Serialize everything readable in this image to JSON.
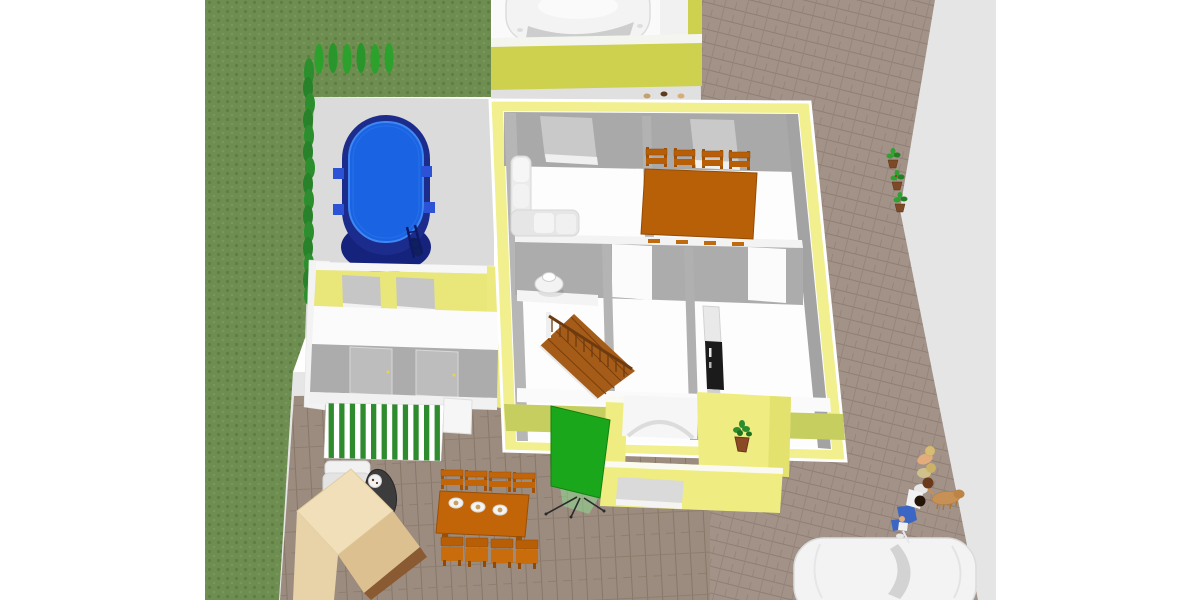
{
  "view": {
    "type": "3d-home-design-render",
    "camera": "aerial-oblique",
    "background": "#ffffff"
  },
  "colors": {
    "grass": "#6D8E50",
    "grass_dot_dark": "#5E7E42",
    "grass_dot_light": "#7B9B5C",
    "hedge_green": "#2C8F2E",
    "tree_green": "#2CA12C",
    "deck": "#DBDBDB",
    "ground_gray": "#E5E5E5",
    "pool_rim": "#1B2C8C",
    "pool_water": "#1A64E4",
    "house_wall": "#F1EF8E",
    "house_wall_south": "#C5CE5F",
    "garage_wall": "#CDD14E",
    "interior_wall": "#A9A9A9",
    "floor_white": "#FDFDFD",
    "wood": "#C26508",
    "dining_wood": "#B86008",
    "stairs": "#A55C18",
    "rail_brown": "#6E3A10",
    "fridge": "#1B1B1B",
    "awning_green": "#2E8B2E",
    "awning_white": "#FFFFFF",
    "screen_green": "#1BA71B",
    "paving": "#A29288",
    "paving_patio": "#9C8C80",
    "car_white": "#F3F3F3",
    "counter_beige": "#F0DFB8",
    "counter_tan": "#DCC090",
    "dog_tan": "#C79055",
    "jeans_blue": "#3B66C4",
    "pot_brown": "#7C4A26",
    "plant_green": "#2FA12F"
  },
  "scene": {
    "garden": {
      "label": "lawn",
      "hedge_bush_count": 15,
      "cypress_tree_count": 6
    },
    "pool": {
      "label": "oval swimming pool",
      "skimmer_count": 4,
      "has_ladder": true
    },
    "garage": {
      "label": "garage with parked car",
      "car_count": 1,
      "shoe_pair_count": 3
    },
    "house": {
      "label": "single-storey house",
      "rooms": [
        "living room",
        "dining room",
        "bathroom",
        "hallway",
        "kitchen",
        "stair hall"
      ],
      "furniture": [
        "corner sofa",
        "dining table",
        "4 dining chairs",
        "washbasin table",
        "wooden staircase",
        "refrigerator"
      ]
    },
    "pool_house": {
      "label": "pool house",
      "window_count": 2,
      "door_count": 2
    },
    "porch": {
      "label": "entrance porch with arch",
      "window_count": 1,
      "potted_plant_count": 1
    },
    "patio": {
      "label": "paved terrace",
      "awning": "green-white striped awning",
      "furniture": [
        "outdoor sofa",
        "barbecue grill",
        "outdoor kitchen counter",
        "outdoor dining table",
        "8 outdoor chairs",
        "3 place settings",
        "green presentation screen on tripod"
      ]
    },
    "driveway": {
      "label": "paved driveway",
      "potted_plant_count": 3,
      "person_count": 5,
      "dog_count": 1,
      "car_count": 1
    }
  }
}
